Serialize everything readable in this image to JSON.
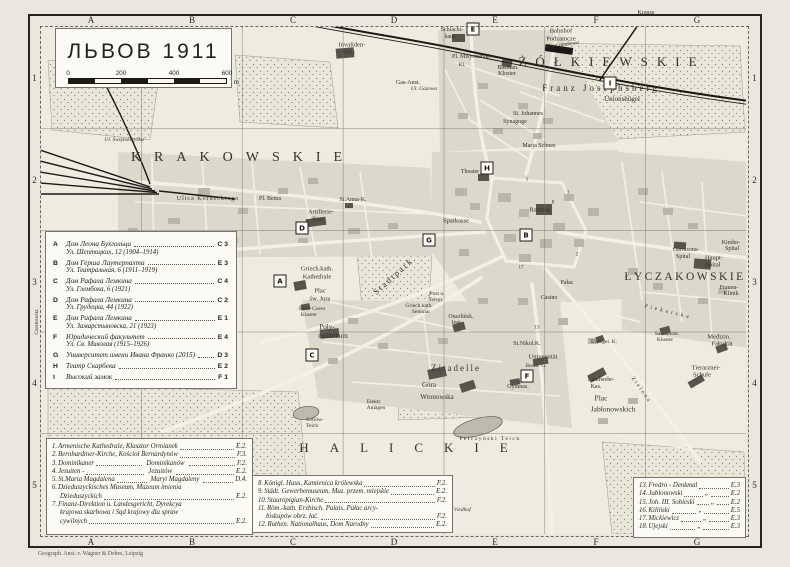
{
  "title_box": {
    "title": "ЛЬВОВ 1911",
    "scale": {
      "labels": [
        "0",
        "200",
        "400",
        "600"
      ],
      "unit": "m"
    }
  },
  "grid": {
    "cols": [
      "A",
      "B",
      "C",
      "D",
      "E",
      "F",
      "G"
    ],
    "rows": [
      "1",
      "2",
      "3",
      "4",
      "5"
    ]
  },
  "imprint": "Geograph. Anst. v. Wagner & Debes, Leipzig",
  "legend": {
    "items": [
      {
        "key": "A",
        "name": "Дом Леона Бухгольца",
        "addr": "Ул. Шептицких, 12 (1904–1914)",
        "ref": "C 3"
      },
      {
        "key": "B",
        "name": "Дом Герша Лаутерпахта",
        "addr": "Ул. Театральная, 6 (1911–1919)",
        "ref": "E 3"
      },
      {
        "key": "C",
        "name": "Дом Рафала Лемкина",
        "addr": "Ул. Глембока, 6 (1921)",
        "ref": "C 4"
      },
      {
        "key": "D",
        "name": "Дом Рафала Лемкина",
        "addr": "Ул. Грудецка, 44 (1922)",
        "ref": "C 2"
      },
      {
        "key": "E",
        "name": "Дом Рафала Лемкина",
        "addr": "Ул. Замарстыновска, 21 (1923)",
        "ref": "E 1"
      },
      {
        "key": "F",
        "name": "Юридический факультет",
        "addr": "Ул. Св. Миколая (1915–1926)",
        "ref": "E 4"
      },
      {
        "key": "G",
        "name": "Университет имени Ивана Франко (2015)",
        "addr": "",
        "ref": "D 3"
      },
      {
        "key": "H",
        "name": "Театр Скарбека",
        "addr": "",
        "ref": "E 2"
      },
      {
        "key": "I",
        "name": "Высокий замок",
        "addr": "",
        "ref": "F 1"
      }
    ]
  },
  "bottom_legend": {
    "columns": [
      {
        "items": [
          {
            "num": "1.",
            "lines": [
              "Armenische Kathedrale, Klasztor Ormianek"
            ],
            "ref": "E.2."
          },
          {
            "num": "2.",
            "lines": [
              "Bernhardiner-Kirche, Kościoł Bernardynów"
            ],
            "ref": "F.3."
          },
          {
            "num": "3.",
            "lines": [
              "Dominikaner"
            ],
            "right": "Dominikanów",
            "ref": "F.2."
          },
          {
            "num": "4.",
            "lines": [
              "Jesuiten -"
            ],
            "right": "Jezuitów",
            "ref": "E.2."
          },
          {
            "num": "5.",
            "lines": [
              "St.Maria Magdalena"
            ],
            "right": "Maryi Magdaleny",
            "ref": "D.4."
          },
          {
            "num": "6.",
            "lines": [
              "Dzieduszyckisches Museum, Muzeum imienia",
              "Dzieduszyckich"
            ],
            "ref": "E.2."
          },
          {
            "num": "7.",
            "lines": [
              "Finanz-Direktion u. Landesgericht, Dyrekcya",
              "krajowa skarbowa i Sąd krajowy dla spraw",
              "cywilnych"
            ],
            "ref": "E.2."
          }
        ]
      },
      {
        "items": [
          {
            "num": "8.",
            "lines": [
              "Königl. Haus, Kamienica królewska"
            ],
            "ref": "F.2."
          },
          {
            "num": "9.",
            "lines": [
              "Städt. Gewerbemuseum, Muz. przem. miejskie"
            ],
            "ref": "E.2."
          },
          {
            "num": "10.",
            "lines": [
              "Stauropigian-Kirche"
            ],
            "ref": "F.2."
          },
          {
            "num": "11.",
            "lines": [
              "Röm.-kath. Erzbisch. Palais, Pałac arcy-",
              "biskupów obrz. łać."
            ],
            "ref": "F.2."
          },
          {
            "num": "12.",
            "lines": [
              "Ruthen. Nationalhaus, Dom Narodny"
            ],
            "ref": "E.2."
          }
        ]
      },
      {
        "items": [
          {
            "num": "13.",
            "lines": [
              "Fredro - Denkmal"
            ],
            "ref": "E.3"
          },
          {
            "num": "14.",
            "lines": [
              "Jabłonowski"
            ],
            "ditto": "„",
            "ref": "E.2"
          },
          {
            "num": "15.",
            "lines": [
              "Joh. III. Sobieski"
            ],
            "ditto": "„",
            "ref": "E.2"
          },
          {
            "num": "16.",
            "lines": [
              "Kiliński"
            ],
            "ditto": "„",
            "ref": "E.5"
          },
          {
            "num": "17.",
            "lines": [
              "Mickiewicz"
            ],
            "ditto": "„",
            "ref": "E.3"
          },
          {
            "num": "18.",
            "lines": [
              "Ujejski"
            ],
            "ditto": "„",
            "ref": "E.3"
          }
        ]
      }
    ]
  },
  "map": {
    "markers": [
      {
        "k": "A",
        "x": 280,
        "y": 281
      },
      {
        "k": "B",
        "x": 526,
        "y": 235
      },
      {
        "k": "C",
        "x": 312,
        "y": 355
      },
      {
        "k": "D",
        "x": 302,
        "y": 228
      },
      {
        "k": "E",
        "x": 473,
        "y": 29
      },
      {
        "k": "F",
        "x": 527,
        "y": 376
      },
      {
        "k": "G",
        "x": 429,
        "y": 240
      },
      {
        "k": "H",
        "x": 487,
        "y": 168
      },
      {
        "k": "I",
        "x": 610,
        "y": 83
      }
    ],
    "labels": [
      {
        "t": "KRAKOWSKIE",
        "x": 243,
        "y": 158,
        "s": 14,
        "ls": 13
      },
      {
        "t": "ŻÓŁKIEWSKIE",
        "x": 612,
        "y": 62,
        "s": 13,
        "ls": 9
      },
      {
        "t": "ŁYCZAKOWSKIE",
        "x": 685,
        "y": 277,
        "s": 11.5,
        "ls": 2.5
      },
      {
        "t": "HALICKIE",
        "x": 414,
        "y": 448,
        "s": 13,
        "ls": 21
      },
      {
        "t": "Invaliden-",
        "x": 352,
        "y": 45,
        "s": 6.5
      },
      {
        "t": "haus",
        "x": 349,
        "y": 52,
        "s": 6.5
      },
      {
        "t": "Schlacht-",
        "x": 452,
        "y": 30,
        "s": 6
      },
      {
        "t": "haus",
        "x": 450,
        "y": 37,
        "s": 6
      },
      {
        "t": "Bahnhof",
        "x": 561,
        "y": 31,
        "s": 6.5
      },
      {
        "t": "Podzamcze",
        "x": 561,
        "y": 39,
        "s": 6.5
      },
      {
        "t": "Krause",
        "x": 646,
        "y": 13,
        "s": 6
      },
      {
        "t": "Basilian.",
        "x": 508,
        "y": 68,
        "s": 6
      },
      {
        "t": "Kloster",
        "x": 507,
        "y": 74,
        "s": 6
      },
      {
        "t": "Pl. Misyonarski",
        "x": 471,
        "y": 57,
        "s": 6
      },
      {
        "t": "Kl.",
        "x": 462,
        "y": 65,
        "s": 5.5
      },
      {
        "t": "Gas-Anst.",
        "x": 408,
        "y": 83,
        "s": 6
      },
      {
        "t": "Ul. Gazowa",
        "x": 424,
        "y": 89,
        "s": 5.5,
        "it": true
      },
      {
        "t": "Franz Josephsberg",
        "x": 601,
        "y": 88,
        "s": 9,
        "ls": 3
      },
      {
        "t": "Unionshügel",
        "x": 622,
        "y": 99,
        "s": 7
      },
      {
        "t": "St. Johannes",
        "x": 528,
        "y": 114,
        "s": 6
      },
      {
        "t": "Synagoge",
        "x": 515,
        "y": 122,
        "s": 6
      },
      {
        "t": "Marja Schnee",
        "x": 539,
        "y": 146,
        "s": 6
      },
      {
        "t": "Ulica zamkowa",
        "x": 562,
        "y": 45,
        "s": 5.5,
        "it": true,
        "rot": -7
      },
      {
        "t": "Ul. Świętokrzyska",
        "x": 124,
        "y": 140,
        "s": 5.5,
        "it": true
      },
      {
        "t": "Ulica Kordeckiego",
        "x": 208,
        "y": 199,
        "s": 6,
        "ls": 1
      },
      {
        "t": "Pl. Bema",
        "x": 270,
        "y": 199,
        "s": 6
      },
      {
        "t": "Artillerie-",
        "x": 321,
        "y": 212,
        "s": 6.5
      },
      {
        "t": "Kas.",
        "x": 318,
        "y": 219,
        "s": 6.5
      },
      {
        "t": "St.Anna-K.",
        "x": 353,
        "y": 200,
        "s": 6
      },
      {
        "t": "Theater",
        "x": 470,
        "y": 172,
        "s": 6
      },
      {
        "t": "Rathaus",
        "x": 540,
        "y": 210,
        "s": 6.5
      },
      {
        "t": "Sparkasse",
        "x": 456,
        "y": 221,
        "s": 6.5
      },
      {
        "t": "Griech.kath.",
        "x": 317,
        "y": 269,
        "s": 6.5
      },
      {
        "t": "Kathedrale",
        "x": 317,
        "y": 277,
        "s": 6.5
      },
      {
        "t": "Plac",
        "x": 320,
        "y": 291,
        "s": 6.5
      },
      {
        "t": "św. Jura",
        "x": 320,
        "y": 299,
        "s": 6.5
      },
      {
        "t": "Sacré Coeur",
        "x": 312,
        "y": 309,
        "s": 5.5
      },
      {
        "t": "Kloster",
        "x": 309,
        "y": 315,
        "s": 5.5
      },
      {
        "t": "Poly-",
        "x": 327,
        "y": 327,
        "s": 7
      },
      {
        "t": "technikum",
        "x": 333,
        "y": 336,
        "s": 7
      },
      {
        "t": "Stadtpark",
        "x": 393,
        "y": 276,
        "s": 8.5,
        "rot": -42,
        "ls": 2
      },
      {
        "t": "Griech.kath.",
        "x": 419,
        "y": 306,
        "s": 5.5
      },
      {
        "t": "Seminar",
        "x": 421,
        "y": 312,
        "s": 5.5
      },
      {
        "t": "Post u.",
        "x": 437,
        "y": 294,
        "s": 5.5
      },
      {
        "t": "Telegr.",
        "x": 436,
        "y": 300,
        "s": 5.5
      },
      {
        "t": "Ossolińsk.",
        "x": 461,
        "y": 317,
        "s": 6
      },
      {
        "t": "Inst.",
        "x": 457,
        "y": 323,
        "s": 6
      },
      {
        "t": "Casino",
        "x": 549,
        "y": 298,
        "s": 6
      },
      {
        "t": "Pałac",
        "x": 567,
        "y": 283,
        "s": 6
      },
      {
        "t": "St.Nikol.K.",
        "x": 527,
        "y": 344,
        "s": 6
      },
      {
        "t": "Universität",
        "x": 543,
        "y": 357,
        "s": 6.5
      },
      {
        "t": "Botan. G.",
        "x": 536,
        "y": 366,
        "s": 5.5,
        "it": true
      },
      {
        "t": "Gymnas.",
        "x": 518,
        "y": 387,
        "s": 6
      },
      {
        "t": "Zitadelle",
        "x": 456,
        "y": 368,
        "s": 9,
        "ls": 2
      },
      {
        "t": "Góra",
        "x": 429,
        "y": 385,
        "s": 7
      },
      {
        "t": "Wronowska",
        "x": 437,
        "y": 397,
        "s": 7
      },
      {
        "t": "Sofiów-",
        "x": 315,
        "y": 420,
        "s": 5.5
      },
      {
        "t": "Teich",
        "x": 312,
        "y": 426,
        "s": 5.5
      },
      {
        "t": "Elektr.",
        "x": 374,
        "y": 402,
        "s": 5.5
      },
      {
        "t": "Anlagen",
        "x": 376,
        "y": 408,
        "s": 5.5
      },
      {
        "t": "Pełczyński Teich",
        "x": 490,
        "y": 439,
        "s": 5.5,
        "ls": 1.5
      },
      {
        "t": "Plac",
        "x": 601,
        "y": 398,
        "s": 7.5
      },
      {
        "t": "Jabłonowskich",
        "x": 613,
        "y": 409,
        "s": 7.5
      },
      {
        "t": "Landwehr-",
        "x": 601,
        "y": 380,
        "s": 6
      },
      {
        "t": "Kas.",
        "x": 596,
        "y": 387,
        "s": 6
      },
      {
        "t": "Evangel. K.",
        "x": 604,
        "y": 342,
        "s": 5.5
      },
      {
        "t": "Tierarznei-",
        "x": 706,
        "y": 368,
        "s": 6.5
      },
      {
        "t": "Schule",
        "x": 702,
        "y": 375,
        "s": 6.5
      },
      {
        "t": "Medizin.",
        "x": 719,
        "y": 337,
        "s": 6.5
      },
      {
        "t": "Fakultät",
        "x": 722,
        "y": 344,
        "s": 6.5
      },
      {
        "t": "Haupt-",
        "x": 714,
        "y": 258,
        "s": 6.5
      },
      {
        "t": "Spital",
        "x": 713,
        "y": 265,
        "s": 6.5
      },
      {
        "t": "Frauen-",
        "x": 729,
        "y": 288,
        "s": 6
      },
      {
        "t": "Klinik",
        "x": 731,
        "y": 294,
        "s": 6
      },
      {
        "t": "Garnisons-",
        "x": 686,
        "y": 250,
        "s": 6
      },
      {
        "t": "Spital",
        "x": 683,
        "y": 257,
        "s": 6
      },
      {
        "t": "Kinder-",
        "x": 731,
        "y": 243,
        "s": 6
      },
      {
        "t": "Spital",
        "x": 732,
        "y": 249,
        "s": 6
      },
      {
        "t": "Sacrament.",
        "x": 667,
        "y": 334,
        "s": 5.5
      },
      {
        "t": "Kloster",
        "x": 665,
        "y": 340,
        "s": 5.5
      },
      {
        "t": "Kiliński-",
        "x": 652,
        "y": 500,
        "s": 6
      },
      {
        "t": "Park",
        "x": 650,
        "y": 508,
        "s": 6
      },
      {
        "t": "Zielona",
        "x": 641,
        "y": 390,
        "s": 5.5,
        "rot": 55,
        "ls": 2
      },
      {
        "t": "Piekarska",
        "x": 668,
        "y": 312,
        "s": 5.5,
        "rot": 14,
        "ls": 3
      },
      {
        "t": "Friedhof",
        "x": 461,
        "y": 510,
        "s": 5.5,
        "it": true
      },
      {
        "t": "Czernowitz",
        "x": 37,
        "y": 322,
        "s": 5.5,
        "rot": -90
      },
      {
        "t": "1",
        "x": 527,
        "y": 180,
        "s": 5
      },
      {
        "t": "3",
        "x": 568,
        "y": 193,
        "s": 5
      },
      {
        "t": "8",
        "x": 553,
        "y": 203,
        "s": 5
      },
      {
        "t": "2",
        "x": 577,
        "y": 255,
        "s": 5
      },
      {
        "t": "17",
        "x": 521,
        "y": 268,
        "s": 5
      },
      {
        "t": "13",
        "x": 537,
        "y": 328,
        "s": 5
      }
    ]
  }
}
